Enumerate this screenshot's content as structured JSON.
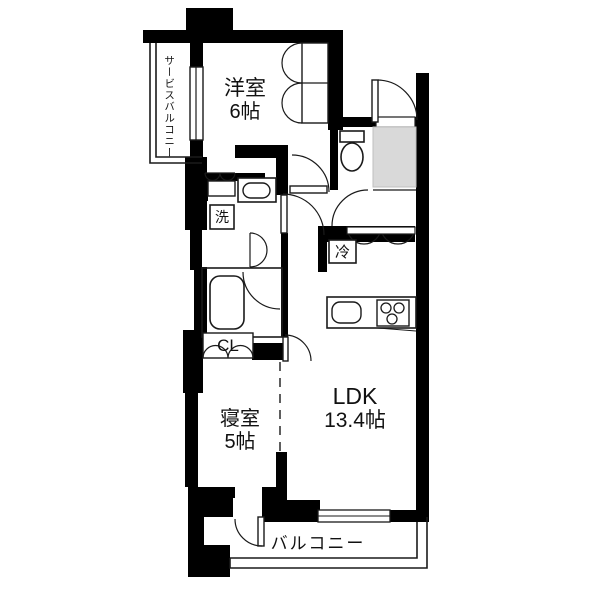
{
  "title": "マンション間取り図",
  "colors": {
    "wall": "#000000",
    "background": "#ffffff",
    "entry_fill": "#d9d9d9",
    "line": "#1a1a1a"
  },
  "rooms": {
    "western_room": {
      "name": "洋室",
      "size": "6帖"
    },
    "bedroom": {
      "name": "寝室",
      "size": "5帖"
    },
    "ldk": {
      "name": "LDK",
      "size": "13.4帖"
    },
    "balcony": {
      "name": "バルコニー"
    },
    "service_balcony": {
      "name": "サービスバルコニー"
    }
  },
  "labels": {
    "washer": "洗",
    "refrigerator": "冷",
    "closet": "CL"
  },
  "fixtures": [
    "toilet",
    "bathtub",
    "washbasin",
    "kitchen-sink",
    "gas-stove",
    "entry-door",
    "room-doors",
    "closet-doors",
    "windows"
  ]
}
